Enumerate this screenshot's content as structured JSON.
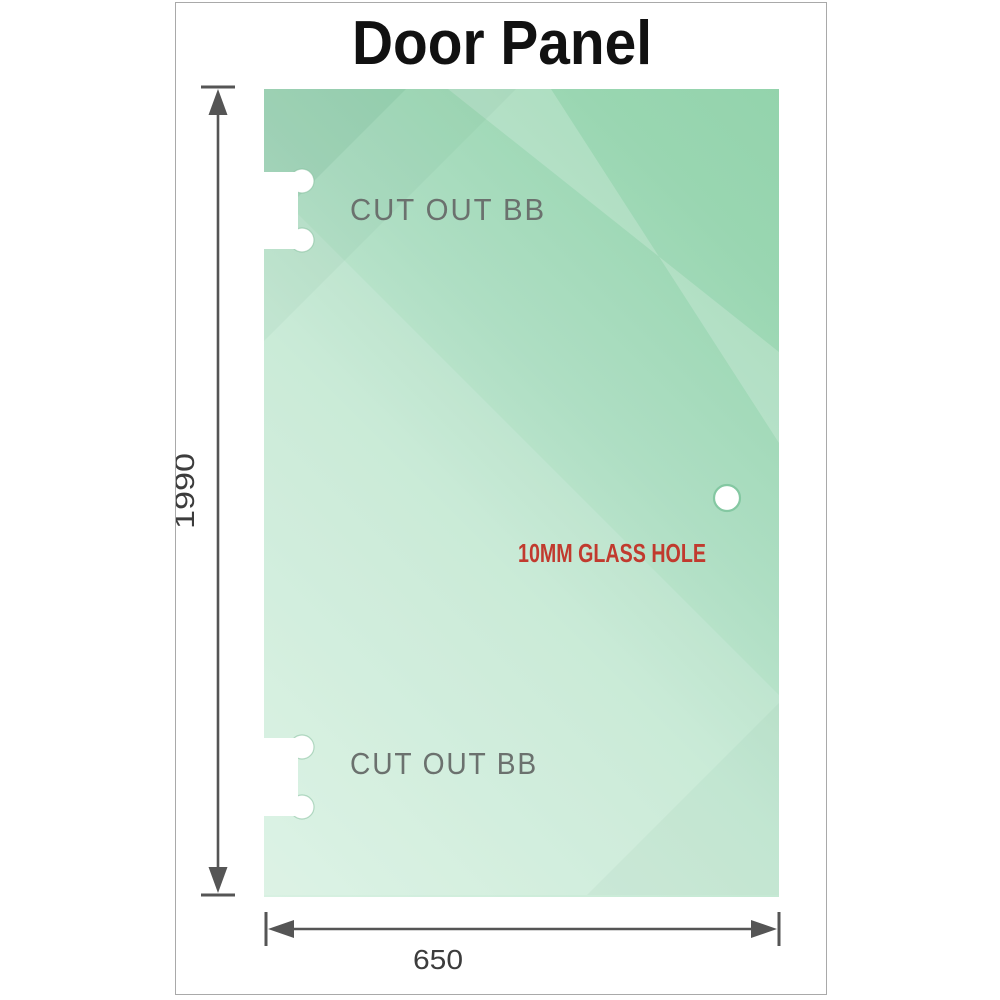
{
  "title": "Door Panel",
  "panel": {
    "cutouts": [
      {
        "label": "CUT OUT BB"
      },
      {
        "label": "CUT OUT BB"
      }
    ],
    "hole": {
      "label": "10MM GLASS HOLE"
    }
  },
  "dimensions": {
    "height": {
      "value": "1990"
    },
    "width": {
      "value": "650"
    }
  },
  "colors": {
    "frame_border": "#a9a9a9",
    "glass_light": "#d8f1e2",
    "glass_mid": "#aedec3",
    "glass_dark": "#8bcfa5",
    "label_gray": "#6b716e",
    "dimension_line": "#555555",
    "dimension_text": "#3c3c3c",
    "hole_label_red": "#c13a2e",
    "title_color": "#111111"
  }
}
